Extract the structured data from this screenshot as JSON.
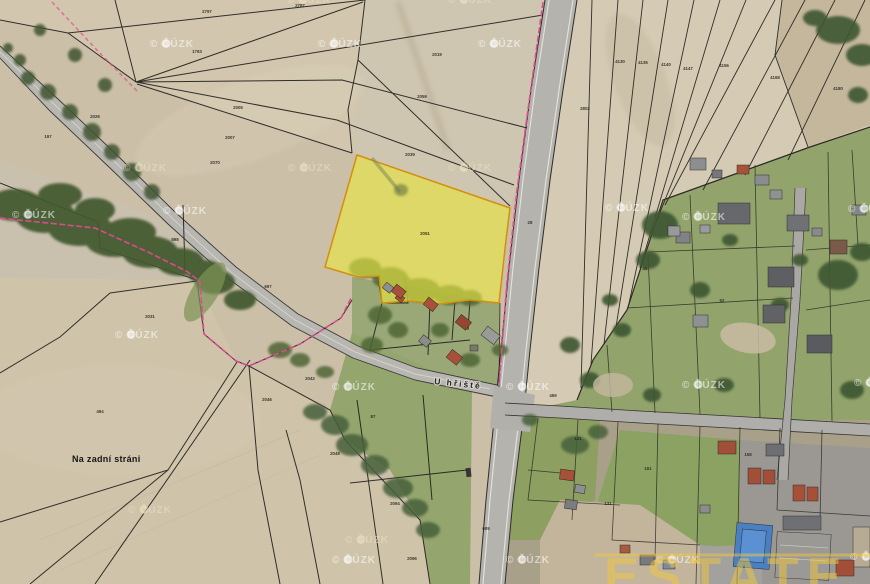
{
  "map": {
    "field_label": "Na zadní stráni",
    "street_label": "U hřiště",
    "selected_parcel": {
      "number": "2051"
    },
    "watermark_text": "© ČÚZK",
    "big_watermark": "ESTATE",
    "colors": {
      "highlight_fill": "#e9e63f",
      "highlight_outline": "#d4900a",
      "cadastral_line": "#1f1e1a",
      "boundary_pink": "#e04a90",
      "big_watermark_yellow": "#f2c83c",
      "road_gray": "#b8b6b0",
      "tree_green": "#43582f",
      "garden_green": "#92a46c"
    },
    "watermarks_white": [
      [
        150,
        47
      ],
      [
        318,
        47
      ],
      [
        478,
        47
      ],
      [
        12,
        218
      ],
      [
        163,
        214
      ],
      [
        605,
        211
      ],
      [
        682,
        220
      ],
      [
        848,
        212
      ],
      [
        332,
        390
      ],
      [
        506,
        390
      ],
      [
        682,
        388
      ],
      [
        854,
        386
      ],
      [
        332,
        563
      ],
      [
        506,
        563
      ],
      [
        656,
        563
      ],
      [
        850,
        560
      ],
      [
        115,
        338
      ]
    ],
    "watermarks_cream": [
      [
        123,
        171
      ],
      [
        288,
        171
      ],
      [
        448,
        171
      ],
      [
        287,
        3
      ],
      [
        448,
        3
      ],
      [
        128,
        513
      ],
      [
        345,
        543
      ]
    ],
    "parcel_numbers": [
      {
        "x": 207,
        "y": 13,
        "n": "2797"
      },
      {
        "x": 300,
        "y": 7,
        "n": "2787"
      },
      {
        "x": 197,
        "y": 53,
        "n": "1793"
      },
      {
        "x": 238,
        "y": 109,
        "n": "2005"
      },
      {
        "x": 230,
        "y": 139,
        "n": "2007"
      },
      {
        "x": 215,
        "y": 164,
        "n": "2070"
      },
      {
        "x": 437,
        "y": 56,
        "n": "2019"
      },
      {
        "x": 422,
        "y": 98,
        "n": "2059"
      },
      {
        "x": 410,
        "y": 156,
        "n": "2039"
      },
      {
        "x": 95,
        "y": 118,
        "n": "2026"
      },
      {
        "x": 48,
        "y": 138,
        "n": "197"
      },
      {
        "x": 175,
        "y": 241,
        "n": "898"
      },
      {
        "x": 268,
        "y": 288,
        "n": "697"
      },
      {
        "x": 310,
        "y": 380,
        "n": "2042"
      },
      {
        "x": 267,
        "y": 401,
        "n": "2046"
      },
      {
        "x": 335,
        "y": 455,
        "n": "2048"
      },
      {
        "x": 150,
        "y": 318,
        "n": "2031"
      },
      {
        "x": 100,
        "y": 413,
        "n": "494"
      },
      {
        "x": 373,
        "y": 418,
        "n": "87"
      },
      {
        "x": 395,
        "y": 505,
        "n": "2094"
      },
      {
        "x": 412,
        "y": 560,
        "n": "2096"
      },
      {
        "x": 530,
        "y": 224,
        "n": "28"
      },
      {
        "x": 585,
        "y": 110,
        "n": "2802"
      },
      {
        "x": 620,
        "y": 63,
        "n": "4130"
      },
      {
        "x": 643,
        "y": 64,
        "n": "4135"
      },
      {
        "x": 666,
        "y": 66,
        "n": "4140"
      },
      {
        "x": 688,
        "y": 70,
        "n": "4147"
      },
      {
        "x": 724,
        "y": 67,
        "n": "4156"
      },
      {
        "x": 775,
        "y": 79,
        "n": "4168"
      },
      {
        "x": 838,
        "y": 90,
        "n": "4180"
      },
      {
        "x": 645,
        "y": 270,
        "n": "45"
      },
      {
        "x": 722,
        "y": 302,
        "n": "52"
      },
      {
        "x": 748,
        "y": 456,
        "n": "158"
      },
      {
        "x": 648,
        "y": 470,
        "n": "161"
      },
      {
        "x": 486,
        "y": 530,
        "n": "609"
      },
      {
        "x": 553,
        "y": 397,
        "n": "459"
      },
      {
        "x": 578,
        "y": 440,
        "n": "121"
      },
      {
        "x": 608,
        "y": 505,
        "n": "131"
      }
    ]
  }
}
